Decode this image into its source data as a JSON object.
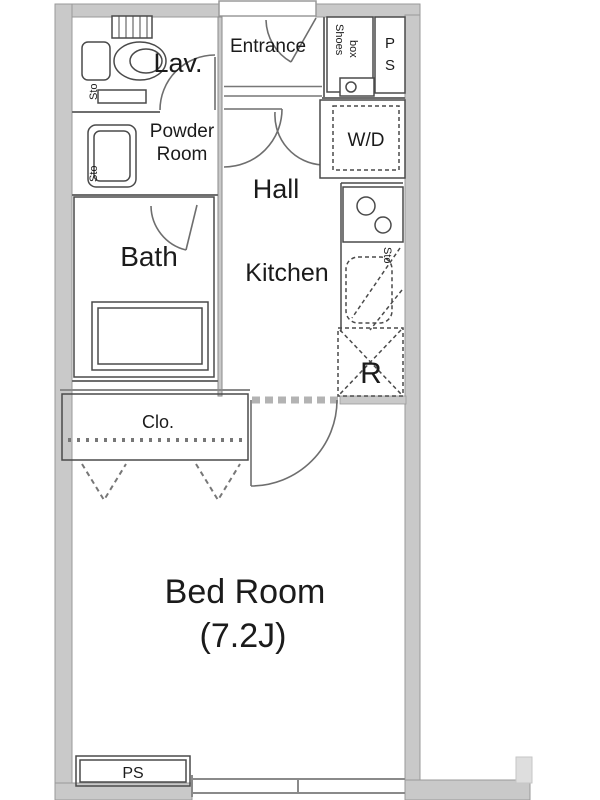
{
  "plan": {
    "rooms": {
      "entrance": "Entrance",
      "lav": "Lav.",
      "powder_line1": "Powder",
      "powder_line2": "Room",
      "hall": "Hall",
      "bath": "Bath",
      "kitchen": "Kitchen",
      "bedroom_line1": "Bed Room",
      "bedroom_line2": "(7.2J)",
      "closet": "Clo."
    },
    "labels": {
      "wd": "W/D",
      "fridge": "R",
      "shoes_line1": "Shoes",
      "shoes_line2": "box",
      "ps_top_line1": "P",
      "ps_top_line2": "S",
      "ps_bottom": "PS",
      "sto_lav": "Sto",
      "sto_powder": "Sto",
      "sto_kitchen": "Sto"
    },
    "colors": {
      "wall_fill": "#c9c9c9",
      "wall_edge": "#999999",
      "line": "#4a4a4a",
      "light_line": "#8a8a8a",
      "text": "#1b1b1b"
    }
  }
}
